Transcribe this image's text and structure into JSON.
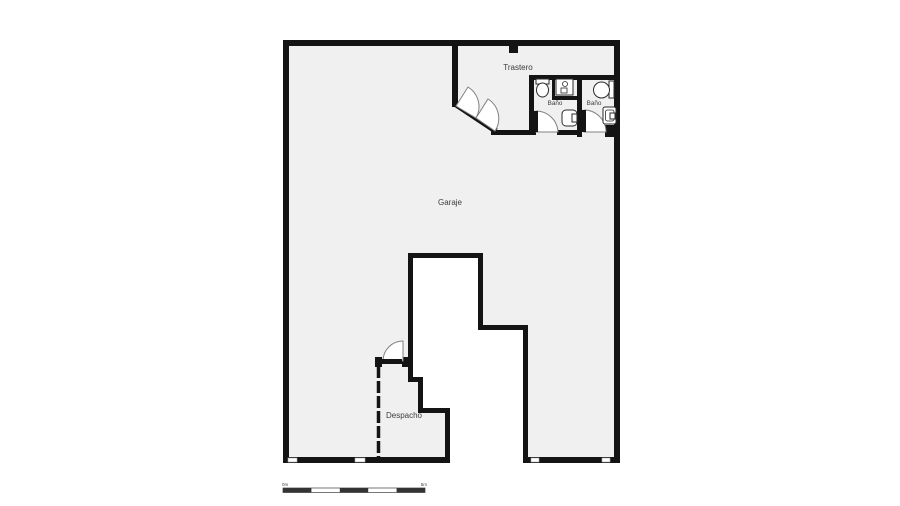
{
  "plan": {
    "type": "floorplan",
    "rooms": {
      "garaje": {
        "label": "Garaje"
      },
      "trastero": {
        "label": "Trastero"
      },
      "bano_left": {
        "label": "Baño"
      },
      "bano_right": {
        "label": "Baño"
      },
      "despacho": {
        "label": "Despacho"
      }
    },
    "fixtures": [
      "toilet-left-bath",
      "basin-alcove-left-bath",
      "wall-sink-left-bath",
      "toilet-right-bath",
      "wall-sink-right-bath"
    ],
    "doors": [
      "double-door-garaje-trastero",
      "door-bano-left",
      "door-bano-right",
      "door-despacho"
    ],
    "scale_bar": {
      "start_label": "0m",
      "end_label": "5m"
    },
    "colors": {
      "wall": "#141414",
      "floor": "#f0f0f0",
      "outside": "#ffffff",
      "door_stroke": "#808080",
      "fixture_stroke": "#2b2b2b",
      "label_text": "#3c3c3c",
      "scale_dark": "#333333"
    }
  }
}
